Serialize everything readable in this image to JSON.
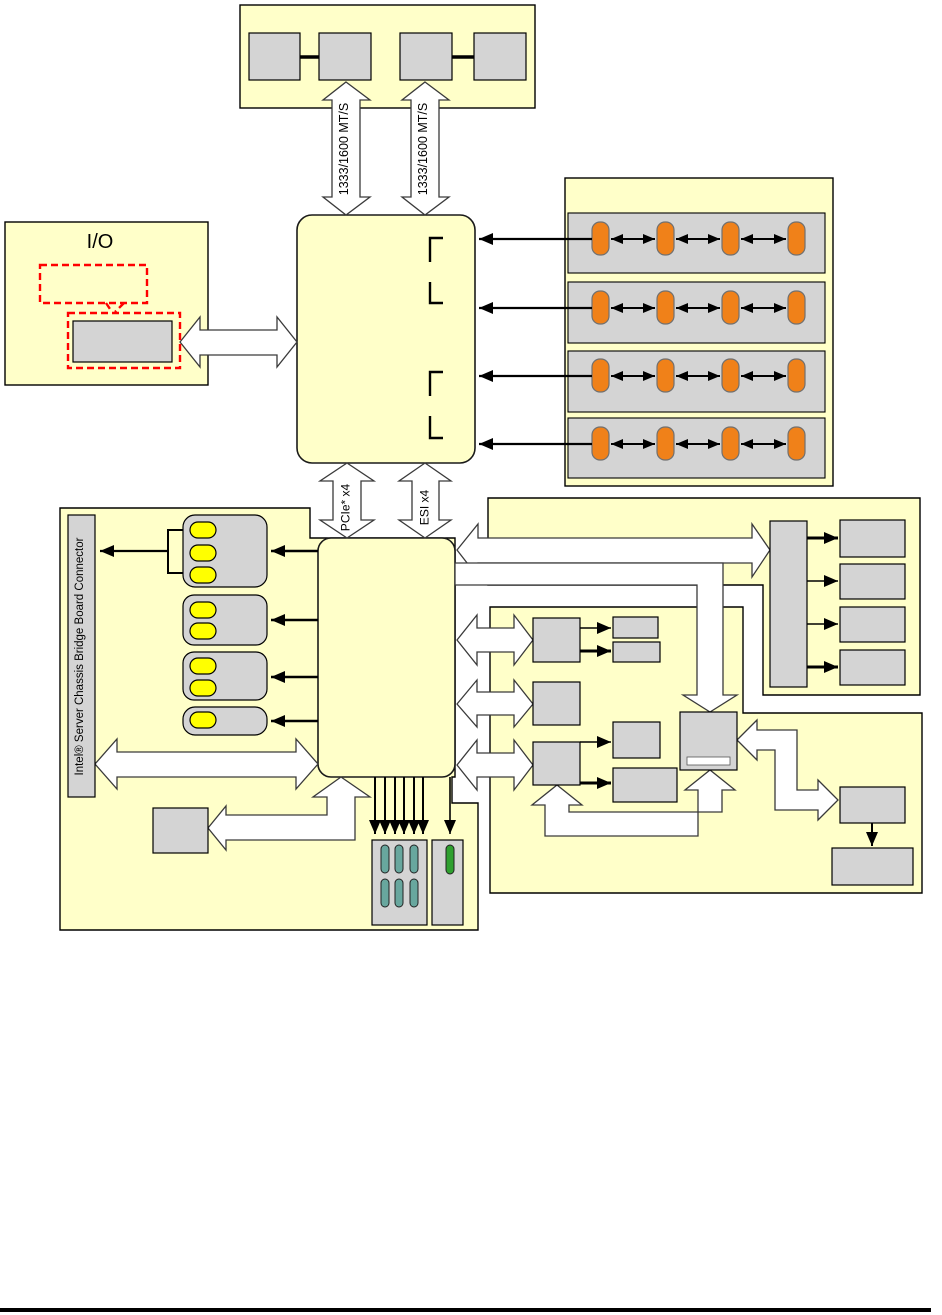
{
  "labels": {
    "io": "I/O",
    "ram_channel_a": "1333/1600 MT/S",
    "ram_channel_b": "1333/1600 MT/S",
    "pcie": "PCIe* x4",
    "esi": "ESI x4",
    "chassis_connector": "Intel® Server Chassis Bridge Board Connector"
  },
  "colors": {
    "yellow": "#FFFFC9",
    "gray": "#D4D4D4",
    "orange": "#F08119",
    "yellowpill": "#FFFF00",
    "teal": "#68A79E",
    "green": "#2FA02F",
    "red": "#FF0000"
  }
}
